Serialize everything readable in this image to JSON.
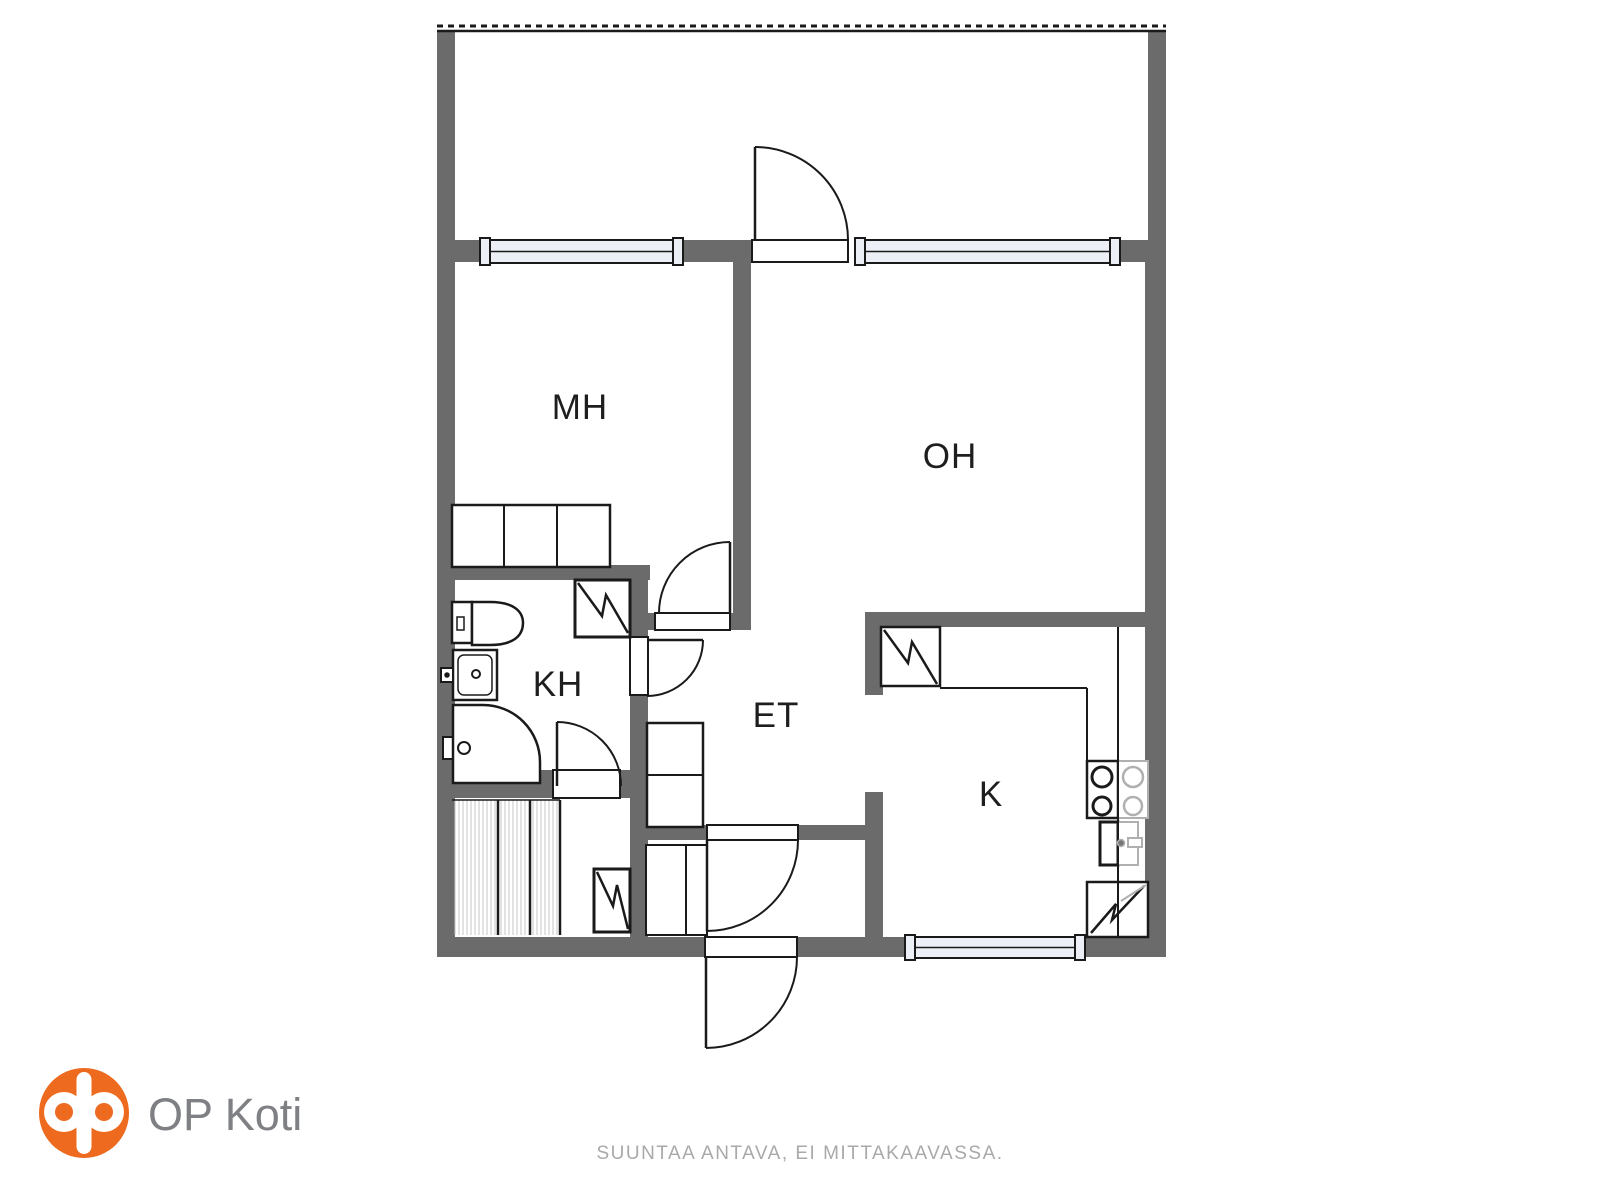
{
  "rooms": {
    "mh": {
      "label": "MH"
    },
    "oh": {
      "label": "OH"
    },
    "kh": {
      "label": "KH"
    },
    "et": {
      "label": "ET"
    },
    "k": {
      "label": "K"
    }
  },
  "footer": {
    "logo_text": "OP Koti",
    "disclaimer": "SUUNTAA ANTAVA, EI MITTAKAAVASSA."
  },
  "colors": {
    "wall": "#6b6b6b",
    "line": "#1a1a1a",
    "gray_line": "#b0b0b0",
    "window_fill": "#edeff6",
    "stripe": "#c4c4c4",
    "logo_orange": "#ed6a1f",
    "logo_text": "#7e8083",
    "disclaimer_text": "#a9a9a9"
  },
  "plan": {
    "walls": [
      [
        "balcony-left-wall",
        437,
        30,
        18,
        212
      ],
      [
        "balcony-right-wall",
        1148,
        30,
        18,
        212
      ],
      [
        "outer-left-wall",
        437,
        240,
        18,
        717
      ],
      [
        "outer-right-wall",
        1145,
        240,
        21,
        717
      ],
      [
        "outer-bottom-wall",
        437,
        937,
        729,
        20
      ],
      [
        "window-band-left",
        455,
        240,
        25,
        22
      ],
      [
        "window-band-mid",
        683,
        240,
        69,
        22
      ],
      [
        "window-band-right",
        1120,
        240,
        28,
        22
      ],
      [
        "mh-kh-wall",
        437,
        565,
        213,
        15
      ],
      [
        "kh-right-wall",
        630,
        565,
        18,
        233
      ],
      [
        "kh-bottom-wall-left",
        437,
        770,
        116,
        28
      ],
      [
        "kh-bottom-wall-right",
        620,
        770,
        28,
        28
      ],
      [
        "sauna-et-wall",
        630,
        798,
        18,
        139
      ],
      [
        "mh-oh-wall",
        733,
        262,
        18,
        368
      ],
      [
        "mh-et-wall",
        648,
        613,
        85,
        17
      ],
      [
        "oh-kitchen-wall",
        865,
        612,
        301,
        15
      ],
      [
        "kitchen-left-wall-top",
        865,
        627,
        18,
        68
      ],
      [
        "kitchen-left-wall-bottom",
        865,
        792,
        18,
        145
      ],
      [
        "vestibule-wall",
        640,
        825,
        243,
        15
      ]
    ],
    "stripes": [
      [
        452,
        800,
        46,
        135
      ],
      [
        498,
        800,
        32,
        135
      ],
      [
        530,
        800,
        30,
        135
      ]
    ],
    "windows": [
      [
        "mh-window",
        480,
        240,
        203,
        23
      ],
      [
        "oh-window",
        855,
        240,
        265,
        23
      ],
      [
        "kitchen-window",
        905,
        937,
        180,
        21
      ]
    ],
    "thresholds": [
      [
        "balcony-door-threshold",
        752,
        240,
        96,
        22
      ],
      [
        "mh-door-threshold",
        655,
        613,
        75,
        17
      ],
      [
        "kh-door-threshold",
        630,
        637,
        18,
        58
      ],
      [
        "sauna-door-threshold",
        553,
        770,
        67,
        28
      ],
      [
        "vestibule-door-threshold",
        707,
        825,
        91,
        15
      ],
      [
        "front-door-threshold",
        705,
        937,
        92,
        20
      ]
    ],
    "rects": [
      [
        "mh-wardrobe",
        452,
        505,
        158,
        62,
        2.5
      ],
      [
        "et-closet",
        647,
        723,
        56,
        104,
        2.5
      ],
      [
        "vestibule-cabinet",
        646,
        845,
        61,
        90,
        2
      ],
      [
        "toilet-tank",
        452,
        602,
        20,
        41,
        2.5
      ],
      [
        "toilet-button",
        457,
        617,
        7,
        13,
        1.5
      ],
      [
        "kh-sink",
        453,
        650,
        44,
        50,
        2.5
      ],
      [
        "kh-sink-basin",
        458,
        655,
        34,
        40,
        1.5,
        null,
        null,
        6
      ],
      [
        "kh-faucet",
        441,
        668,
        12,
        14,
        2
      ],
      [
        "shower-mixer",
        443,
        737,
        12,
        22,
        2
      ],
      [
        "kh-appliance-box",
        575,
        580,
        55,
        57,
        3
      ],
      [
        "sauna-appliance-box",
        594,
        869,
        36,
        63,
        3
      ],
      [
        "fridge-box",
        881,
        627,
        59,
        59,
        2.5
      ],
      [
        "stove",
        1087,
        761,
        31,
        57,
        2.5
      ],
      [
        "stove-ghost",
        1118,
        761,
        30,
        57,
        2,
        "gray"
      ],
      [
        "kitchen-sink",
        1100,
        822,
        18,
        43,
        3
      ],
      [
        "kitchen-sink-ghost",
        1118,
        822,
        20,
        43,
        2,
        "gray"
      ],
      [
        "kitchen-faucet-handle",
        1128,
        838,
        14,
        9,
        2,
        "gray"
      ],
      [
        "kitchen-appliance-box",
        1087,
        882,
        61,
        55,
        2.5
      ]
    ],
    "paths": [
      [
        "toilet-bowl",
        "M 472 602 H 490 C 513 602 523 611 523 623 C 523 636 513 645 490 645 H 472 Z",
        2.5,
        "#fff"
      ],
      [
        "shower-enclosure",
        "M 453 705 H 483 A 57 57 0 0 1 540 762 V 783 H 453 Z",
        2.5,
        "#fff"
      ],
      [
        "kh-appliance-zigzag",
        "M 578 583 L 602 616 L 606 595 L 628 633",
        2.5
      ],
      [
        "sauna-appliance-zigzag",
        "M 597 872 L 613 906 L 617 885 L 628 929",
        2.5
      ],
      [
        "fridge-zigzag",
        "M 884 630 L 908 663 L 912 642 L 937 684",
        2.5
      ],
      [
        "kitchen-appliance-zigzag",
        "M 1091 933 L 1116 904 L 1112 920 L 1144 886",
        2.5
      ],
      [
        "kitchen-appliance-zigzag-ghost",
        "M 1121 901 L 1146 885",
        2,
        null,
        "gray"
      ],
      [
        "balcony-door-arc",
        "M 755 147 A 93 93 0 0 1 848 240",
        2,
        "none"
      ],
      [
        "mh-door-arc",
        "M 730 542 A 71 71 0 0 0 659 613",
        2,
        "none"
      ],
      [
        "kh-door-arc",
        "M 703 640 A 56 56 0 0 1 647 696",
        2,
        "none"
      ],
      [
        "sauna-door-arc",
        "M 557 722 A 64 64 0 0 1 621 786",
        2,
        "none"
      ],
      [
        "vestibule-door-arc",
        "M 798 840 A 91 91 0 0 1 707 931",
        2,
        "none"
      ],
      [
        "front-door-arc",
        "M 797 957 A 91 91 0 0 1 706 1048",
        2,
        "none"
      ]
    ],
    "lines": [
      [
        "balcony-railing",
        437,
        31,
        1166,
        31,
        2.5
      ],
      [
        "balcony-railing-dashes",
        437,
        26,
        1166,
        26,
        3,
        null,
        "6 5"
      ],
      [
        "wardrobe-divider-1",
        504,
        505,
        504,
        567,
        2
      ],
      [
        "wardrobe-divider-2",
        557,
        505,
        557,
        567,
        2
      ],
      [
        "et-closet-divider",
        647,
        775,
        703,
        775,
        2
      ],
      [
        "vestibule-cabinet-divider",
        686,
        845,
        686,
        935,
        2
      ],
      [
        "sauna-panel-divider-1",
        498,
        800,
        498,
        935,
        2.5
      ],
      [
        "sauna-panel-divider-2",
        530,
        800,
        530,
        935,
        2.5
      ],
      [
        "sauna-panel-divider-3",
        560,
        800,
        560,
        935,
        2.5
      ],
      [
        "sauna-panel-top",
        452,
        800,
        560,
        800,
        1.5
      ],
      [
        "kitchen-counter-front",
        940,
        688,
        1087,
        688,
        2
      ],
      [
        "kitchen-counter-side",
        1087,
        688,
        1087,
        761,
        2
      ],
      [
        "kitchen-counter-line",
        1118,
        627,
        1118,
        937,
        2
      ],
      [
        "balcony-door-leaf",
        755,
        147,
        755,
        240,
        2.5
      ],
      [
        "mh-door-leaf",
        730,
        542,
        730,
        613,
        2.5
      ],
      [
        "kh-door-leaf",
        647,
        640,
        703,
        640,
        2.5
      ],
      [
        "sauna-door-leaf",
        557,
        722,
        557,
        786,
        2.5
      ],
      [
        "vestibule-door-leaf",
        707,
        840,
        707,
        931,
        2.5
      ],
      [
        "front-door-leaf",
        706,
        957,
        706,
        1048,
        2.5
      ]
    ],
    "circles": [
      [
        "burner-1",
        1102,
        777,
        10,
        3
      ],
      [
        "burner-2",
        1102,
        806,
        9,
        3
      ],
      [
        "burner-ghost-1",
        1133,
        777,
        10,
        2.5,
        "gray"
      ],
      [
        "burner-ghost-2",
        1133,
        806,
        9,
        2.5,
        "gray"
      ],
      [
        "kh-sink-drain",
        476,
        674,
        4,
        2
      ],
      [
        "kh-faucet-dot",
        447,
        675,
        2,
        1.5,
        null,
        "#1a1a1a"
      ],
      [
        "shower-knob",
        464,
        748,
        6,
        2
      ],
      [
        "kitchen-faucet-dot",
        1121,
        843,
        3.5,
        1.5,
        "gray",
        "#777"
      ]
    ]
  }
}
